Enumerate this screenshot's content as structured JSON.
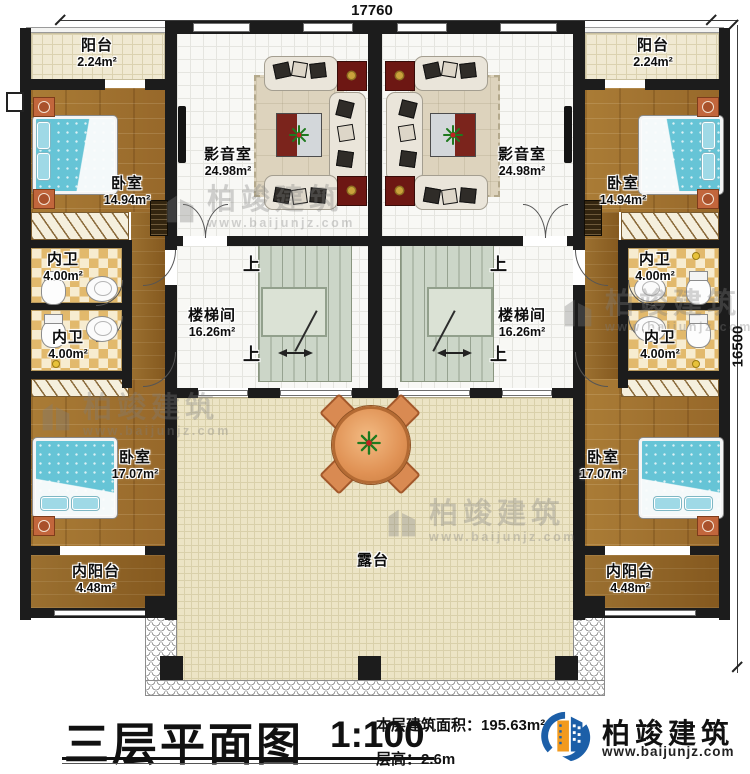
{
  "doc": {
    "title": "三层平面图",
    "scale": "1:100",
    "floor_area_label": "本层建筑面积：",
    "floor_area_value": "195.63m²",
    "floor_height_label": "层高：",
    "floor_height_value": "2.6m"
  },
  "brand": {
    "name": "柏竣建筑",
    "url": "www.baijunjz.com"
  },
  "watermark": {
    "name": "柏竣建筑",
    "url": "www.baijunjz.com"
  },
  "dimensions": {
    "width": "17760",
    "height": "16500"
  },
  "stairs": {
    "up": "上"
  },
  "rooms": {
    "balcony_left": {
      "name": "阳台",
      "area": "2.24m²"
    },
    "balcony_right": {
      "name": "阳台",
      "area": "2.24m²"
    },
    "bedroom_top_left": {
      "name": "卧室",
      "area": "14.94m²"
    },
    "bedroom_top_right": {
      "name": "卧室",
      "area": "14.94m²"
    },
    "theater_left": {
      "name": "影音室",
      "area": "24.98m²"
    },
    "theater_right": {
      "name": "影音室",
      "area": "24.98m²"
    },
    "bath_left_top": {
      "name": "内卫",
      "area": "4.00m²"
    },
    "bath_left_bottom": {
      "name": "内卫",
      "area": "4.00m²"
    },
    "bath_right_top": {
      "name": "内卫",
      "area": "4.00m²"
    },
    "bath_right_bottom": {
      "name": "内卫",
      "area": "4.00m²"
    },
    "stairhall_left": {
      "name": "楼梯间",
      "area": "16.26m²"
    },
    "stairhall_right": {
      "name": "楼梯间",
      "area": "16.26m²"
    },
    "bedroom_bottom_left": {
      "name": "卧室",
      "area": "17.07m²"
    },
    "bedroom_bottom_right": {
      "name": "卧室",
      "area": "17.07m²"
    },
    "inner_balcony_left": {
      "name": "内阳台",
      "area": "4.48m²"
    },
    "inner_balcony_right": {
      "name": "内阳台",
      "area": "4.48m²"
    },
    "terrace": {
      "name": "露台"
    }
  }
}
